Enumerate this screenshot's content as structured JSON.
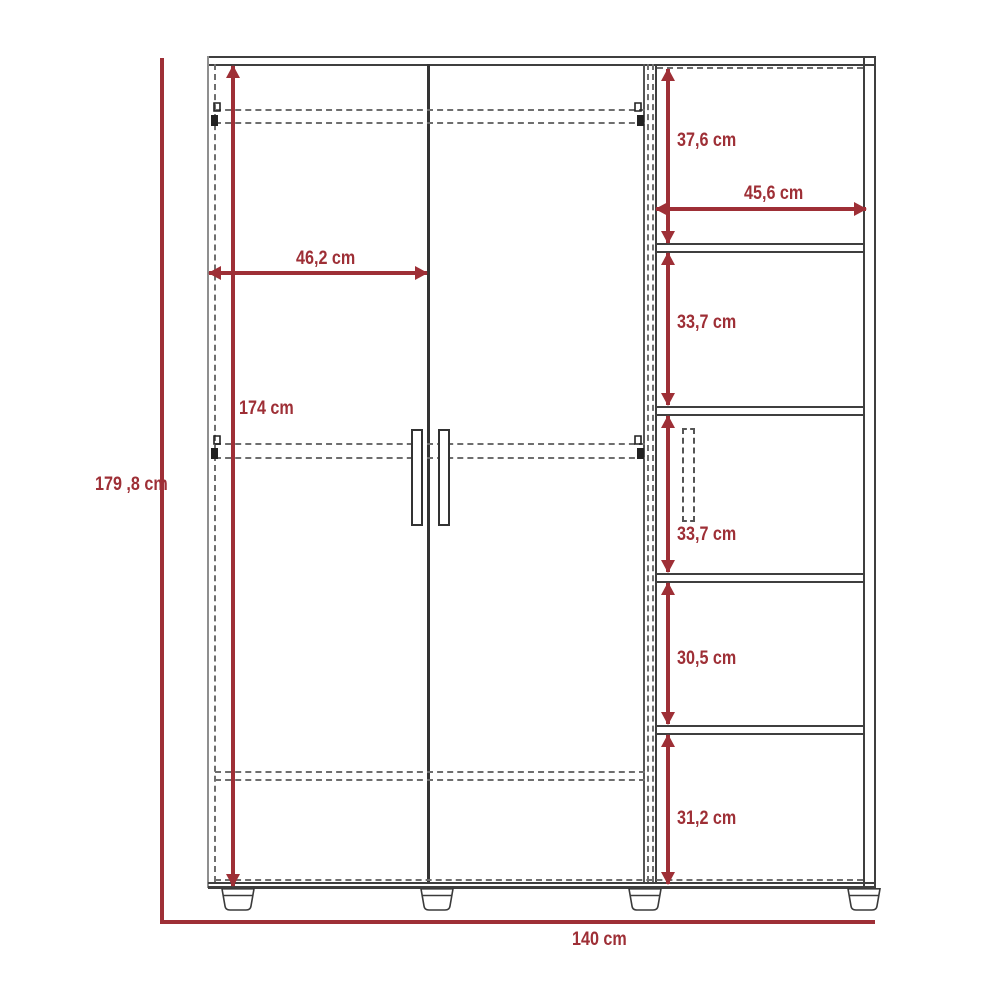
{
  "diagram": {
    "subject": "wardrobe-dimension-diagram",
    "unit": "cm",
    "overall": {
      "height": "179 ,8 cm",
      "width": "140 cm"
    },
    "doors": {
      "width": "46,2 cm",
      "height": "174 cm"
    },
    "shelving": {
      "width": "45,6 cm",
      "sections": [
        {
          "label": "37,6 cm"
        },
        {
          "label": "33,7 cm"
        },
        {
          "label": "33,7 cm"
        },
        {
          "label": "30,5 cm"
        },
        {
          "label": "31,2 cm"
        }
      ]
    },
    "colors": {
      "dimension_red": "#9e2f36",
      "outline_dark": "#3f3f3f",
      "outline_gray": "#8f8f8f",
      "dashed_gray": "#6e6e6e"
    }
  }
}
